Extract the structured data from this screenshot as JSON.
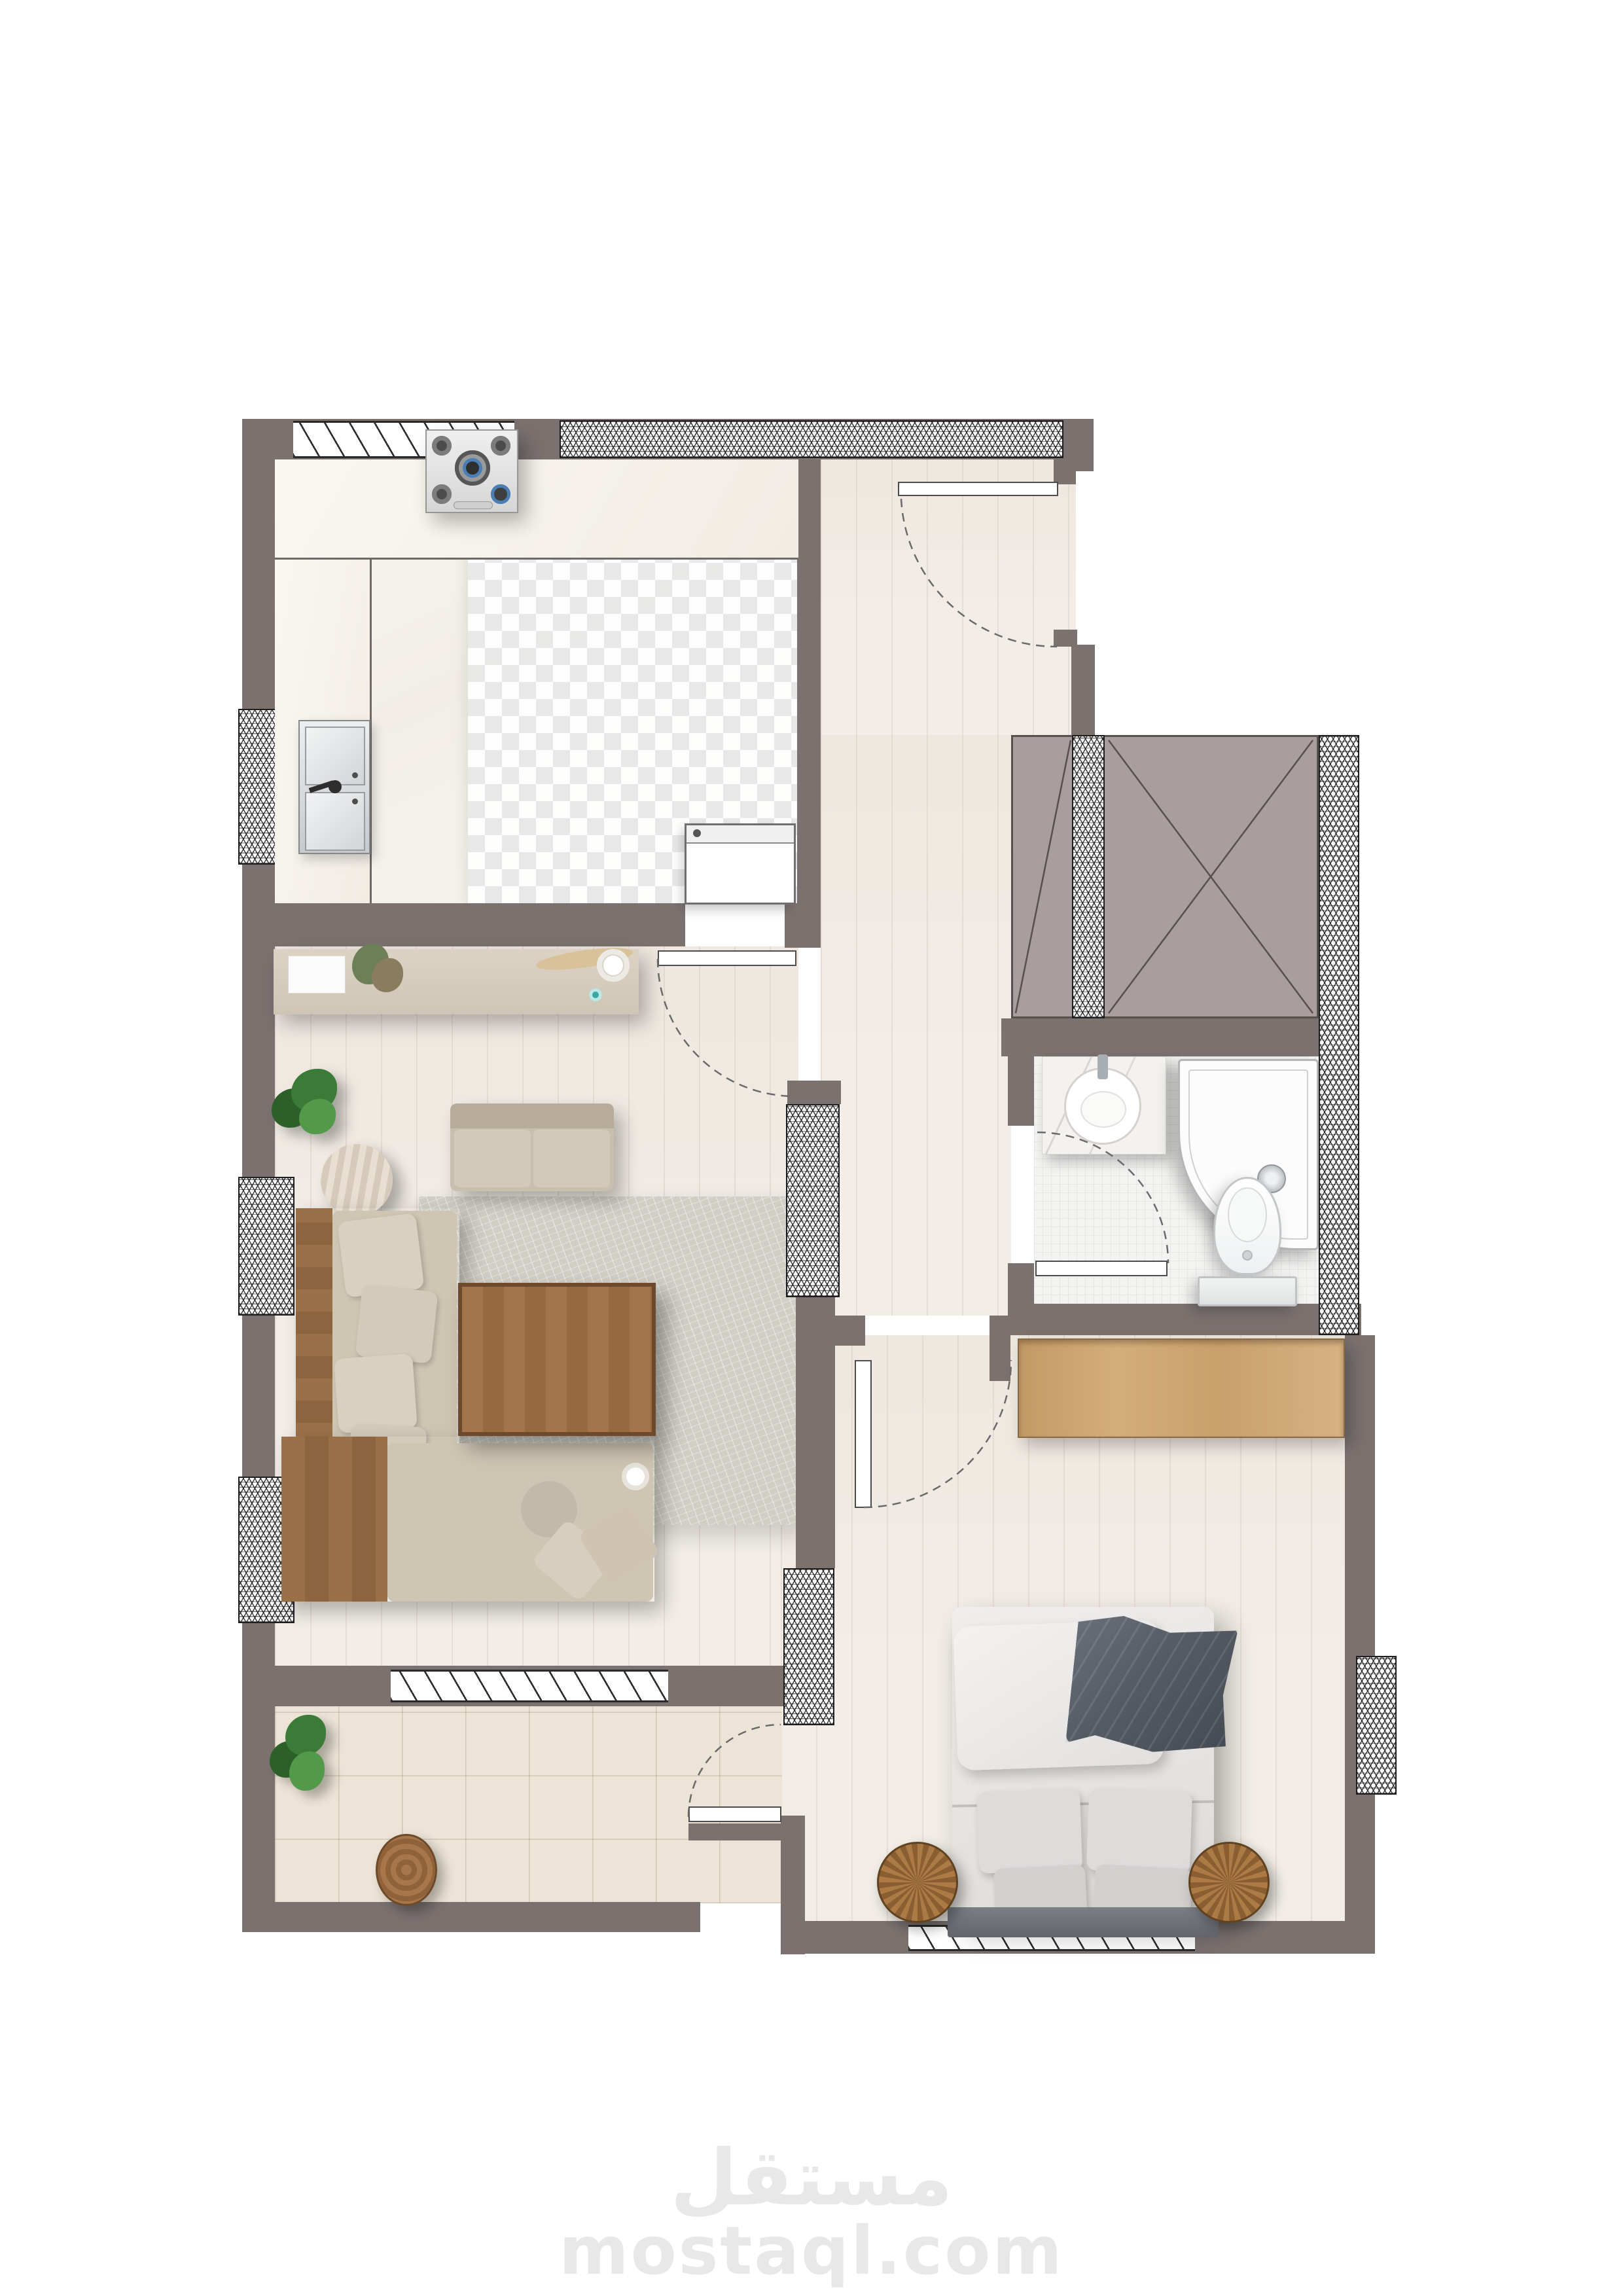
{
  "page": {
    "kind": "furnished apartment floor plan (top-down architectural render)",
    "background": "#ffffff"
  },
  "watermark": {
    "brand_arabic": "مستقل",
    "brand_domain": "mostaql.com",
    "color": "#e8e8e8"
  },
  "palette": {
    "wall": "#7b7270",
    "shaft": "#a89e9d",
    "rug": "#d1cec6",
    "rattan": "#a2774a",
    "wm": "#e8e8e8",
    "wood_furniture": "#9c6f46",
    "wood_light": "#cfa873",
    "sofa_beige": "#cfc5b3",
    "bed_linen": "#e9e7e5",
    "blanket_gray": "#565c64",
    "plant_green": "#3c7a38",
    "floor_wood": "#f2ede7",
    "floor_tile": "#ece4d6",
    "floor_bath": "#f3f3f1",
    "hatch_line": "#1e1e1e"
  },
  "plan": {
    "rooms": [
      {
        "name": "kitchen"
      },
      {
        "name": "hallway"
      },
      {
        "name": "living-room"
      },
      {
        "name": "balcony"
      },
      {
        "name": "bathroom"
      },
      {
        "name": "bedroom"
      },
      {
        "name": "elevator-shaft"
      }
    ],
    "doors": [
      {
        "name": "entrance-door"
      },
      {
        "name": "kitchen-door"
      },
      {
        "name": "bedroom-door"
      },
      {
        "name": "bathroom-door"
      },
      {
        "name": "balcony-door"
      }
    ]
  }
}
